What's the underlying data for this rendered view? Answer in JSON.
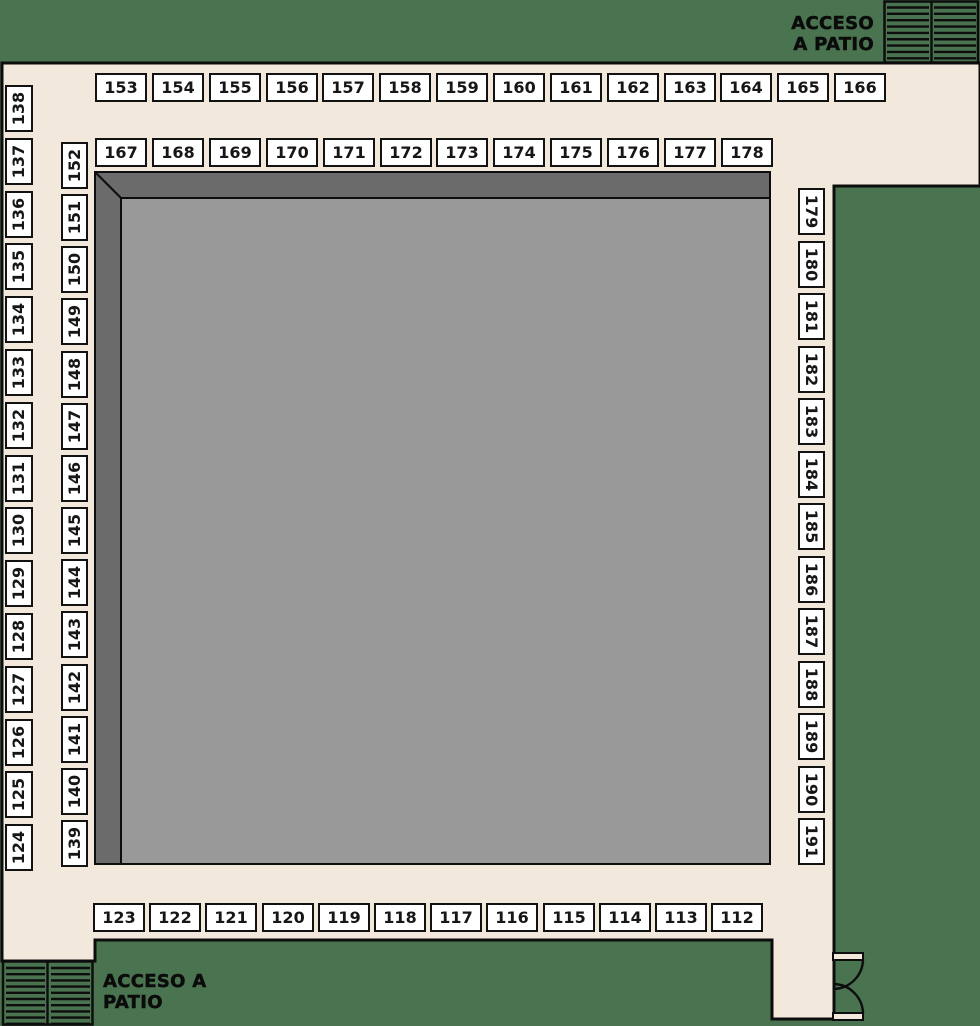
{
  "plan_name": "floor-plan-booths",
  "colors": {
    "green": "#4a7350",
    "cream": "#f2e9dc",
    "gray_light": "#999999",
    "gray_dark": "#6b6b6b",
    "ink": "#0d0d0d",
    "booth_fill": "#ffffff"
  },
  "access_top_right": {
    "line1": "ACCESO",
    "line2": "A PATIO"
  },
  "access_bottom_left": {
    "line1": "ACCESO A",
    "line2": "PATIO"
  },
  "booths": {
    "top_row_outer": [
      "153",
      "154",
      "155",
      "156",
      "157",
      "158",
      "159",
      "160",
      "161",
      "162",
      "163",
      "164",
      "165",
      "166"
    ],
    "top_row_inner": [
      "167",
      "168",
      "169",
      "170",
      "171",
      "172",
      "173",
      "174",
      "175",
      "176",
      "177",
      "178"
    ],
    "left_col_outer": [
      "138",
      "137",
      "136",
      "135",
      "134",
      "133",
      "132",
      "131",
      "130",
      "129",
      "128",
      "127",
      "126",
      "125",
      "124"
    ],
    "left_col_inner": [
      "152",
      "151",
      "150",
      "149",
      "148",
      "147",
      "146",
      "145",
      "144",
      "143",
      "142",
      "141",
      "140",
      "139"
    ],
    "right_col": [
      "179",
      "180",
      "181",
      "182",
      "183",
      "184",
      "185",
      "186",
      "187",
      "188",
      "189",
      "190",
      "191"
    ],
    "bottom_row": [
      "123",
      "122",
      "121",
      "120",
      "119",
      "118",
      "117",
      "116",
      "115",
      "114",
      "113",
      "112"
    ]
  }
}
